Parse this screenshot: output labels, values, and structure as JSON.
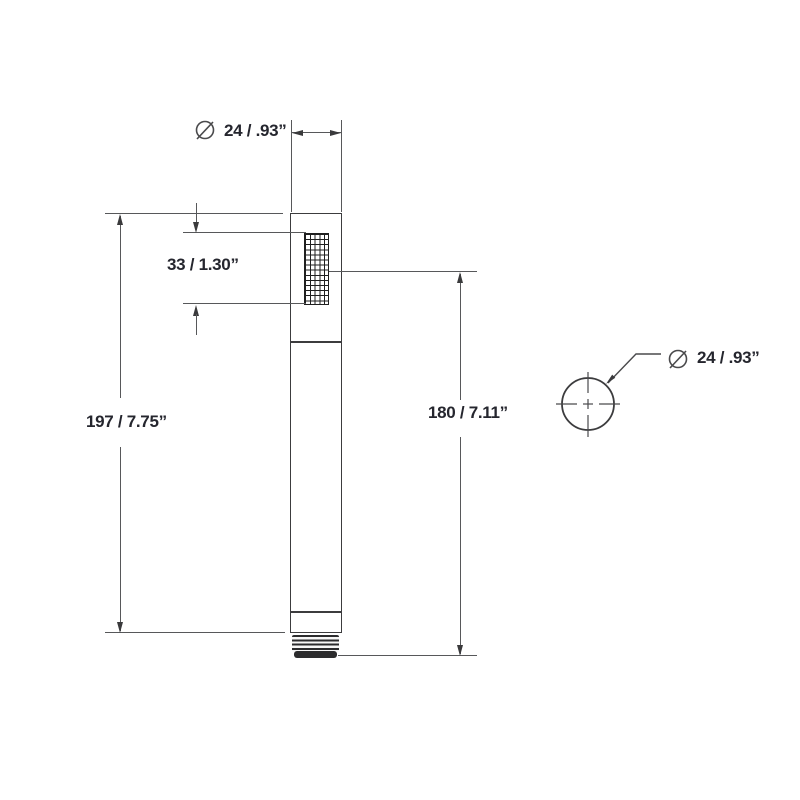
{
  "drawing": {
    "title": "handshower-dimension-drawing",
    "front_view": {
      "top_diameter": {
        "symbol": "Ø",
        "value": "24 / .93”"
      },
      "spray_face_height": {
        "value": "33 / 1.30”"
      },
      "overall_length": {
        "value": "197 / 7.75”"
      },
      "spray_center_to_outlet": {
        "value": "180 / 7.11”"
      }
    },
    "top_view": {
      "diameter": {
        "symbol": "Ø",
        "value": "24 / .93”"
      }
    },
    "colors": {
      "outline": "#3c3c3e",
      "dimension_line": "#57585a",
      "text": "#25262e",
      "background": "#ffffff"
    }
  }
}
